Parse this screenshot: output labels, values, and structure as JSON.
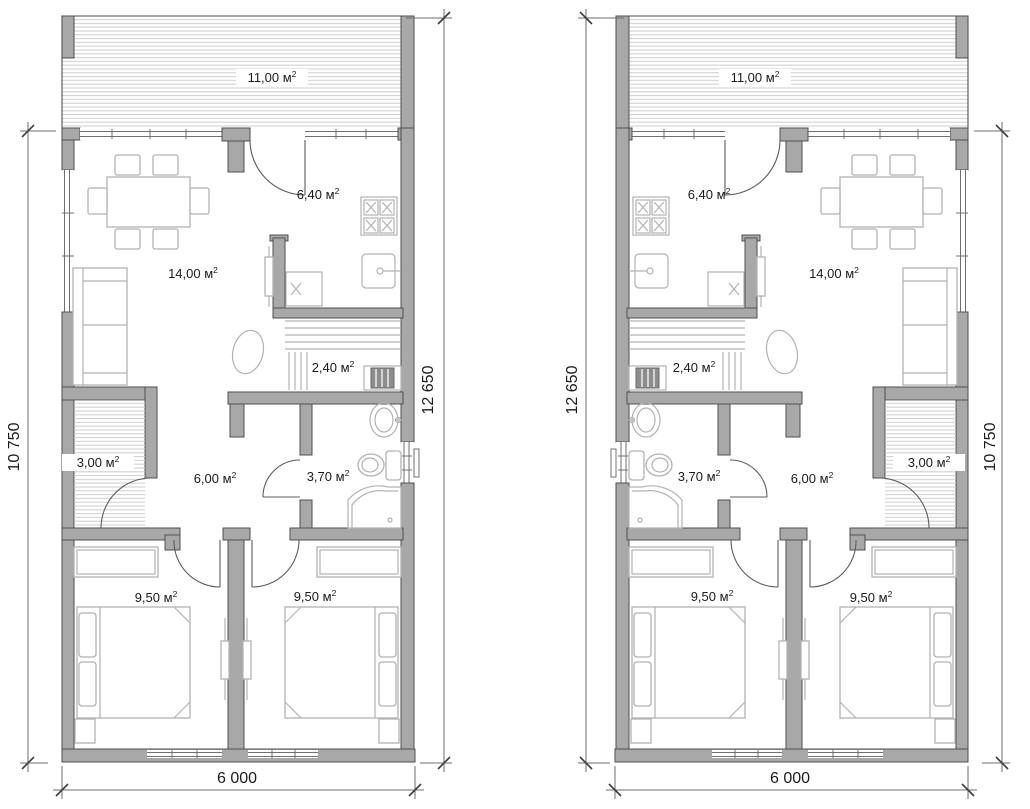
{
  "colors": {
    "wall_fill": "#a8a8a8",
    "wall_stroke": "#4f4f4f",
    "furniture_stroke": "#b2b2b2",
    "hatch_line": "#cdcdcd",
    "dim_line": "#6d6d6d",
    "label_text": "#1b1b1b",
    "heater_fill": "#8d8d8d",
    "background": "#ffffff"
  },
  "plans": [
    {
      "id": "left-unit",
      "room_labels": [
        {
          "name": "terrace",
          "main": "11,00 м",
          "sup": "2",
          "x": 272,
          "y": 82,
          "halo": true
        },
        {
          "name": "kitchen",
          "main": "6,40 м",
          "sup": "2",
          "x": 318,
          "y": 199,
          "halo": false
        },
        {
          "name": "living-room",
          "main": "14,00 м",
          "sup": "2",
          "x": 193,
          "y": 278,
          "halo": false
        },
        {
          "name": "sauna",
          "main": "2,40 м",
          "sup": "2",
          "x": 333,
          "y": 372,
          "halo": false
        },
        {
          "name": "closet",
          "main": "3,00 м",
          "sup": "2",
          "x": 98,
          "y": 467,
          "halo": true
        },
        {
          "name": "hallway",
          "main": "6,00 м",
          "sup": "2",
          "x": 215,
          "y": 483,
          "halo": false
        },
        {
          "name": "bathroom",
          "main": "3,70 м",
          "sup": "2",
          "x": 328,
          "y": 481,
          "halo": false
        },
        {
          "name": "bedroom-left",
          "main": "9,50 м",
          "sup": "2",
          "x": 156,
          "y": 602,
          "halo": false
        },
        {
          "name": "bedroom-right",
          "main": "9,50 м",
          "sup": "2",
          "x": 315,
          "y": 601,
          "halo": false
        }
      ],
      "dimension_labels": [
        {
          "name": "height-left",
          "text": "10 750",
          "x": 19,
          "y": 447,
          "rotate": -90
        },
        {
          "name": "height-right",
          "text": "12 650",
          "x": 433,
          "y": 390,
          "rotate": -90
        },
        {
          "name": "width-bottom",
          "text": "6 000",
          "x": 237,
          "y": 783,
          "rotate": 0
        }
      ]
    },
    {
      "id": "right-unit",
      "room_labels": [
        {
          "name": "terrace",
          "main": "11,00 м",
          "sup": "2",
          "x": 755,
          "y": 82,
          "halo": true
        },
        {
          "name": "kitchen",
          "main": "6,40 м",
          "sup": "2",
          "x": 709,
          "y": 199,
          "halo": false
        },
        {
          "name": "living-room",
          "main": "14,00 м",
          "sup": "2",
          "x": 834,
          "y": 278,
          "halo": false
        },
        {
          "name": "sauna",
          "main": "2,40 м",
          "sup": "2",
          "x": 694,
          "y": 372,
          "halo": false
        },
        {
          "name": "closet",
          "main": "3,00 м",
          "sup": "2",
          "x": 929,
          "y": 467,
          "halo": true
        },
        {
          "name": "hallway",
          "main": "6,00 м",
          "sup": "2",
          "x": 812,
          "y": 483,
          "halo": false
        },
        {
          "name": "bathroom",
          "main": "3,70 м",
          "sup": "2",
          "x": 699,
          "y": 481,
          "halo": false
        },
        {
          "name": "bedroom-left",
          "main": "9,50 м",
          "sup": "2",
          "x": 712,
          "y": 601,
          "halo": false
        },
        {
          "name": "bedroom-right",
          "main": "9,50 м",
          "sup": "2",
          "x": 871,
          "y": 602,
          "halo": false
        }
      ],
      "dimension_labels": [
        {
          "name": "height-left",
          "text": "12 650",
          "x": 577,
          "y": 390,
          "rotate": -90
        },
        {
          "name": "height-right",
          "text": "10 750",
          "x": 995,
          "y": 447,
          "rotate": -90
        },
        {
          "name": "width-bottom",
          "text": "6 000",
          "x": 790,
          "y": 783,
          "rotate": 0
        }
      ]
    }
  ]
}
